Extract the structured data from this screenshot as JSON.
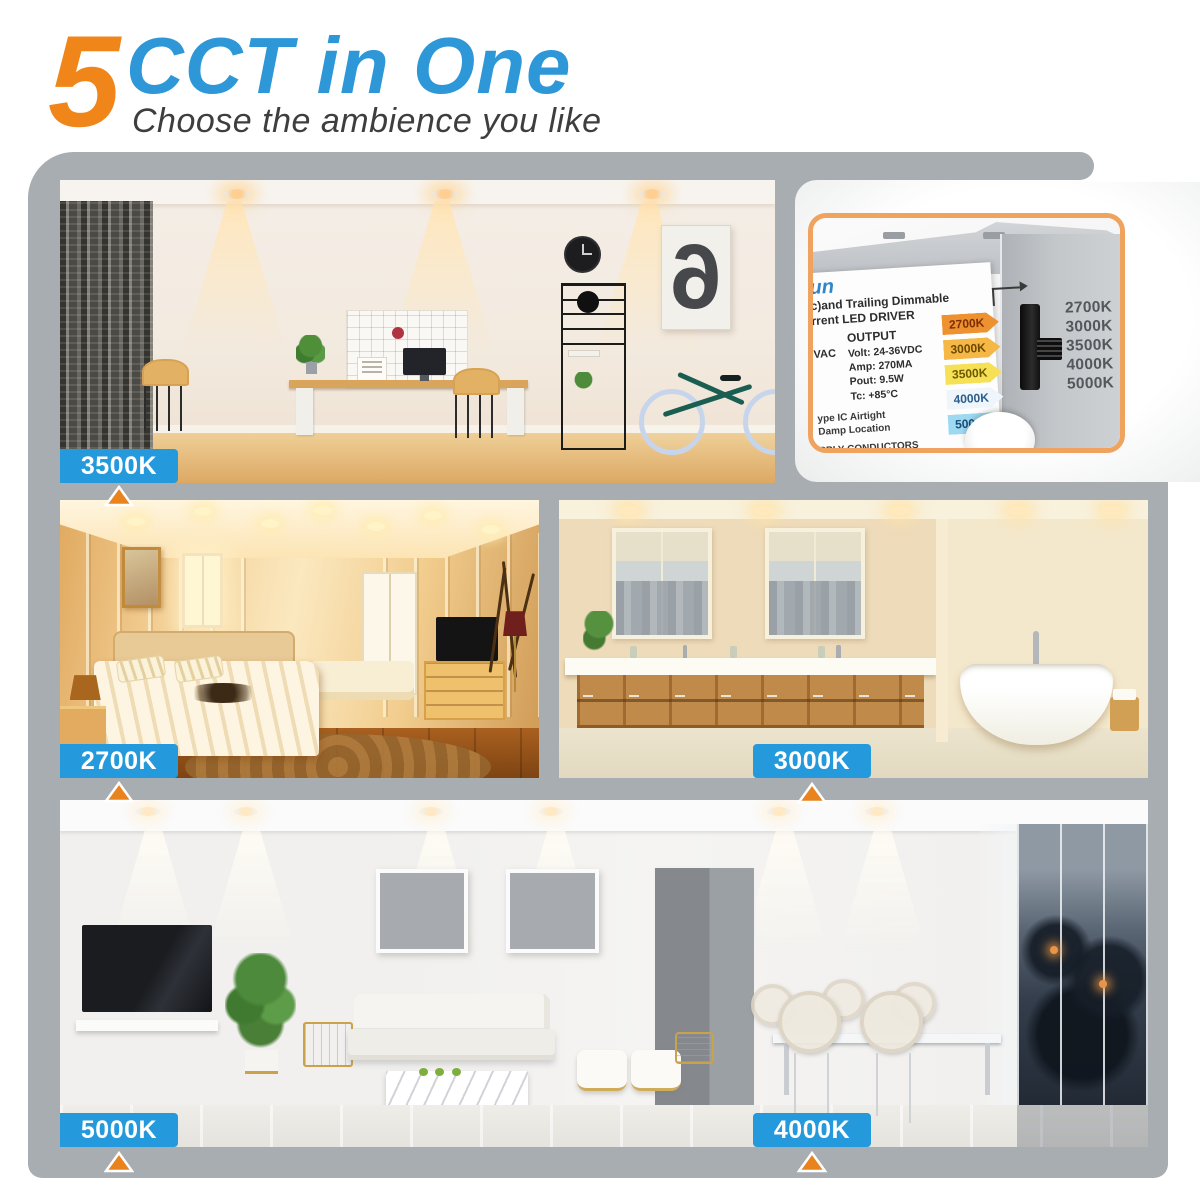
{
  "header": {
    "big_number": "5",
    "title": "CCT in One",
    "subtitle": "Choose the ambience you like"
  },
  "cct_labels": [
    {
      "room": "home-office",
      "value": "3500K"
    },
    {
      "room": "bedroom",
      "value": "2700K"
    },
    {
      "room": "bathroom",
      "value": "3000K"
    },
    {
      "room": "living-room-left",
      "value": "5000K"
    },
    {
      "room": "living-room-right",
      "value": "4000K"
    }
  ],
  "office_poster_number": "6",
  "driver_photo": {
    "brand_fragment": "un",
    "heading_line1": "c)and Trailing Dimmable",
    "heading_line2": "rrent LED DRIVER",
    "input_fragment": "VAC",
    "output_heading": "OUTPUT",
    "specs": [
      "Volt: 24-36VDC",
      "Amp: 270MA",
      "Pout: 9.5W",
      "Tc: +85°C"
    ],
    "cct_tags": [
      "2700K",
      "3000K",
      "3500K",
      "4000K",
      "5000K"
    ],
    "notes": [
      "ype IC Airtight",
      "Damp Location",
      "PPLY CONDUCTORS",
      "LIMENTATIO"
    ],
    "switch_scale": [
      "2700K",
      "3000K",
      "3500K",
      "4000K",
      "5000K"
    ],
    "selected_cct": "3500K"
  },
  "colors": {
    "accent_orange": "#f08519",
    "accent_blue": "#2d97d7",
    "panel_gray": "#a8adb2",
    "label_blue": "#2499dc",
    "pointer_orange": "#e8831d",
    "driver_border_orange": "#f0a35e"
  }
}
